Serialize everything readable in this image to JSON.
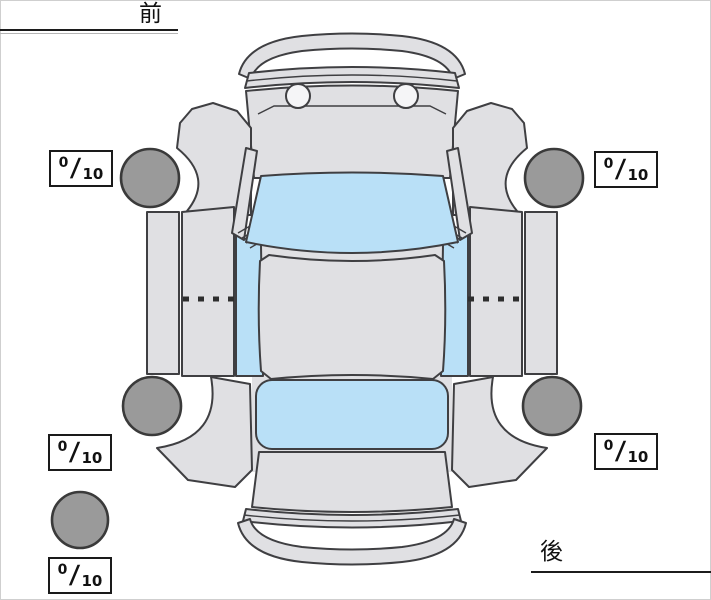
{
  "diagram": {
    "title": "vehicle-top-view-condition-diagram",
    "front_label": "前",
    "rear_label": "後",
    "score_separator": "/",
    "scores": {
      "front_left": {
        "value": "0",
        "max": "10"
      },
      "front_right": {
        "value": "0",
        "max": "10"
      },
      "rear_left": {
        "value": "0",
        "max": "10"
      },
      "rear_right": {
        "value": "0",
        "max": "10"
      },
      "spare": {
        "value": "0",
        "max": "10"
      }
    },
    "colors": {
      "background": "#ffffff",
      "body": "#e0e0e3",
      "outline": "#3f3f42",
      "glass": "#b9e0f7",
      "tire": "#9a9a9a",
      "tire-outline": "#3a3a3a",
      "headlight": "#f5f5f7",
      "box-border": "#1a1a1a",
      "text": "#111111"
    }
  }
}
